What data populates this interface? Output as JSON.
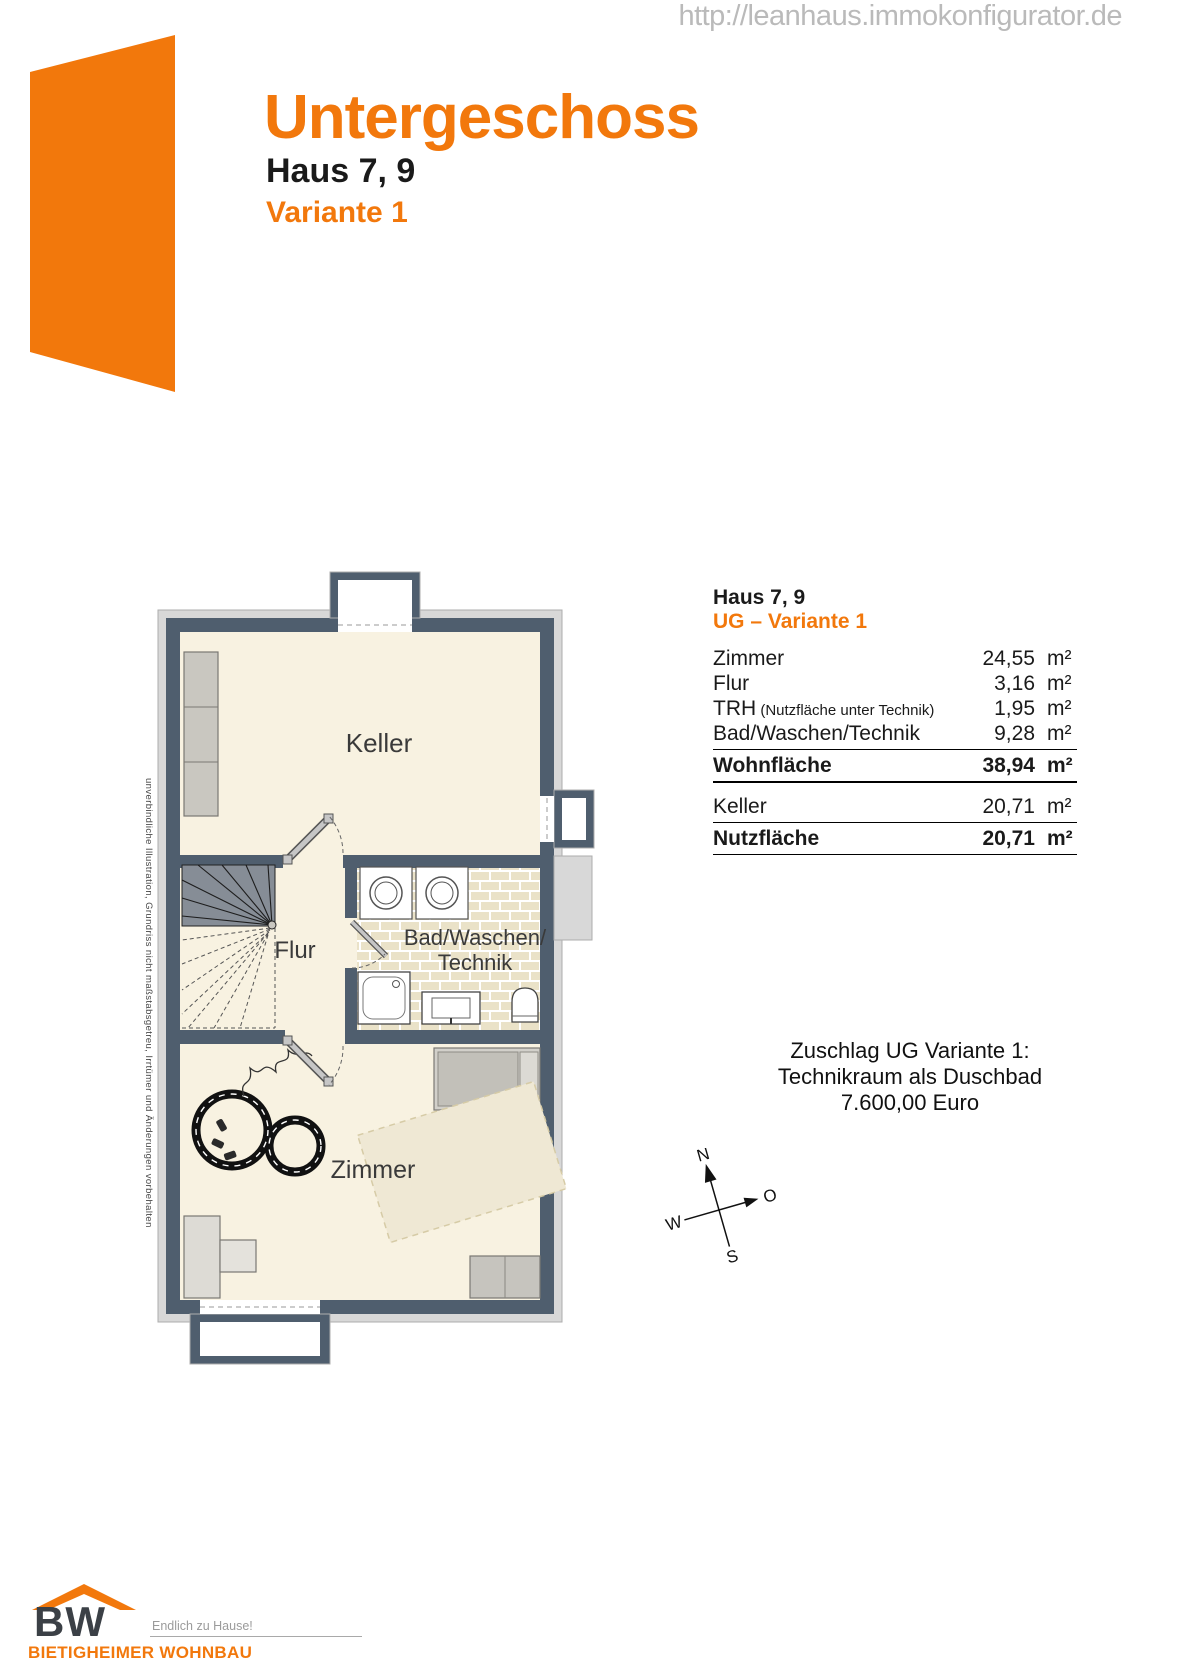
{
  "watermark": "http://leanhaus.immokonfigurator.de",
  "header": {
    "title": "Untergeschoss",
    "subtitle": "Haus 7, 9",
    "variant": "Variante 1"
  },
  "colors": {
    "accent": "#F2780C",
    "wall": "#4F5E6E",
    "floor": "#F8F2E1",
    "tile": "#EAE2C8"
  },
  "plan": {
    "labels": {
      "keller": "Keller",
      "flur": "Flur",
      "bad_line1": "Bad/Waschen/",
      "bad_line2": "Technik",
      "zimmer": "Zimmer"
    },
    "disclaimer": "unverbindliche Illustration, Grundriss nicht maßstabsgetreu, Irrtümer und Änderungen vorbehalten"
  },
  "table": {
    "title": "Haus 7, 9",
    "subtitle": "UG – Variante 1",
    "rows": [
      {
        "label": "Zimmer",
        "value": "24,55",
        "unit": "m²"
      },
      {
        "label": "Flur",
        "value": "3,16",
        "unit": "m²"
      },
      {
        "label": "TRH",
        "note": " (Nutzfläche unter Technik)",
        "value": "1,95",
        "unit": "m²"
      },
      {
        "label": "Bad/Waschen/Technik",
        "value": "9,28",
        "unit": "m²"
      }
    ],
    "wohnflaeche": {
      "label": "Wohnfläche",
      "value": "38,94",
      "unit": "m²"
    },
    "keller": {
      "label": "Keller",
      "value": "20,71",
      "unit": "m²"
    },
    "nutzflaeche": {
      "label": "Nutzfläche",
      "value": "20,71",
      "unit": "m²"
    }
  },
  "surcharge": {
    "line1": "Zuschlag UG Variante 1:",
    "line2": "Technikraum als Duschbad",
    "line3": "7.600,00 Euro"
  },
  "compass": {
    "n": "N",
    "o": "O",
    "s": "S",
    "w": "W"
  },
  "footer": {
    "logo_text": "BW",
    "slogan": "Endlich zu Hause!",
    "company": "BIETIGHEIMER WOHNBAU"
  }
}
